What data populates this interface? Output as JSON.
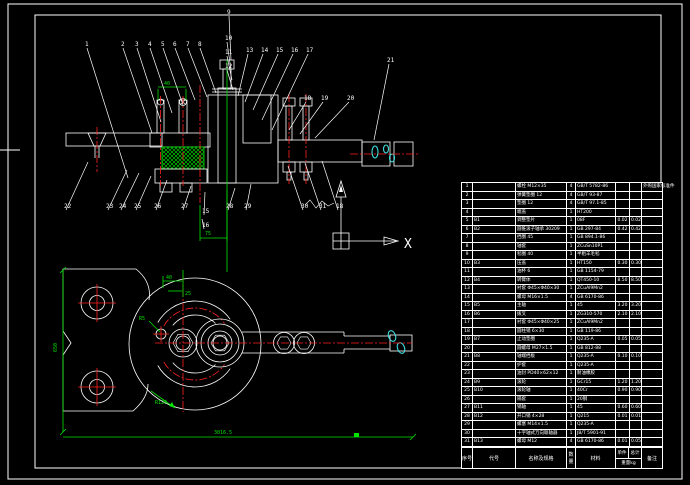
{
  "colors": {
    "background": "#000000",
    "outline": "#ffffff",
    "hatch": "#3fe0e0",
    "dimension": "#00e400",
    "centerline": "#ff2222"
  },
  "ucs": {
    "x_label": "X"
  },
  "dimensions": {
    "stud_spacing": "40",
    "hub_bore": "75",
    "plan_offset_a": "40",
    "plan_offset_b": "25",
    "plan_lead": "R5",
    "plan_arc": "R120",
    "overall_height": "650",
    "overall_width": "3016.5"
  },
  "balloons": [
    {
      "n": "1",
      "x": 85,
      "y": 46,
      "tx": 128,
      "ty": 178
    },
    {
      "n": "2",
      "x": 121,
      "y": 46,
      "tx": 152,
      "ty": 133
    },
    {
      "n": "3",
      "x": 135,
      "y": 46,
      "tx": 161,
      "ty": 122
    },
    {
      "n": "4",
      "x": 148,
      "y": 46,
      "tx": 172,
      "ty": 113
    },
    {
      "n": "5",
      "x": 161,
      "y": 46,
      "tx": 183,
      "ty": 105
    },
    {
      "n": "6",
      "x": 173,
      "y": 46,
      "tx": 195,
      "ty": 100
    },
    {
      "n": "7",
      "x": 186,
      "y": 46,
      "tx": 207,
      "ty": 97
    },
    {
      "n": "8",
      "x": 198,
      "y": 46,
      "tx": 216,
      "ty": 93
    },
    {
      "n": "9",
      "x": 227,
      "y": 14,
      "tx": 231,
      "ty": 60
    },
    {
      "n": "10",
      "x": 225,
      "y": 40,
      "tx": 231,
      "ty": 70
    },
    {
      "n": "11",
      "x": 225,
      "y": 54,
      "tx": 232,
      "ty": 80
    },
    {
      "n": "12",
      "x": 225,
      "y": 68,
      "tx": 233,
      "ty": 90
    },
    {
      "n": "13",
      "x": 246,
      "y": 52,
      "tx": 238,
      "ty": 96
    },
    {
      "n": "14",
      "x": 261,
      "y": 52,
      "tx": 245,
      "ty": 102
    },
    {
      "n": "15",
      "x": 276,
      "y": 52,
      "tx": 253,
      "ty": 110
    },
    {
      "n": "16",
      "x": 291,
      "y": 52,
      "tx": 262,
      "ty": 120
    },
    {
      "n": "17",
      "x": 306,
      "y": 52,
      "tx": 272,
      "ty": 130
    },
    {
      "n": "18",
      "x": 304,
      "y": 100,
      "tx": 289,
      "ty": 130
    },
    {
      "n": "19",
      "x": 321,
      "y": 100,
      "tx": 300,
      "ty": 134
    },
    {
      "n": "20",
      "x": 347,
      "y": 100,
      "tx": 315,
      "ty": 138
    },
    {
      "n": "21",
      "x": 387,
      "y": 62,
      "tx": 374,
      "ty": 140
    },
    {
      "n": "22",
      "x": 64,
      "y": 208,
      "tx": 88,
      "ty": 162
    },
    {
      "n": "23",
      "x": 106,
      "y": 208,
      "tx": 127,
      "ty": 170
    },
    {
      "n": "24",
      "x": 119,
      "y": 208,
      "tx": 139,
      "ty": 173
    },
    {
      "n": "25",
      "x": 134,
      "y": 208,
      "tx": 151,
      "ty": 176
    },
    {
      "n": "26",
      "x": 154,
      "y": 208,
      "tx": 167,
      "ty": 180
    },
    {
      "n": "27",
      "x": 181,
      "y": 208,
      "tx": 191,
      "ty": 186
    },
    {
      "n": "28",
      "x": 226,
      "y": 208,
      "tx": 235,
      "ty": 188
    },
    {
      "n": "29",
      "x": 244,
      "y": 208,
      "tx": 251,
      "ty": 184
    },
    {
      "n": "30",
      "x": 301,
      "y": 208,
      "tx": 288,
      "ty": 166
    },
    {
      "n": "31",
      "x": 319,
      "y": 208,
      "tx": 305,
      "ty": 163
    },
    {
      "n": "18",
      "x": 336,
      "y": 208,
      "tx": 322,
      "ty": 161
    },
    {
      "n": "15",
      "x": 202,
      "y": 213,
      "tx": 205,
      "ty": 192
    },
    {
      "n": "16",
      "x": 202,
      "y": 227,
      "tx": 202,
      "ty": 219
    }
  ],
  "bom": {
    "headers": {
      "no": "序号",
      "code": "代号",
      "name": "名称及规格",
      "qty": "数量",
      "mat": "材料",
      "w1": "单件",
      "w2": "总计",
      "w_sub": "重量kg",
      "rk": "备注"
    },
    "rows": [
      [
        "1",
        "",
        "螺栓 M12×35",
        "4",
        "GB/T 5782-86",
        "",
        "",
        "外购国家标准件"
      ],
      [
        "2",
        "",
        "弹簧垫圈 12",
        "4",
        "GB/T 93-87",
        "",
        "",
        ""
      ],
      [
        "3",
        "",
        "垫圈 12",
        "4",
        "GB/T 97.1-85",
        "",
        "",
        ""
      ],
      [
        "4",
        "",
        "端盖",
        "1",
        "HT200",
        "",
        "",
        ""
      ],
      [
        "5",
        "B1",
        "调整垫片",
        "1",
        "08F",
        "0.02",
        "0.02",
        ""
      ],
      [
        "6",
        "B2",
        "圆锥滚子轴承 30209",
        "1",
        "GB 297-84",
        "0.42",
        "0.42",
        ""
      ],
      [
        "7",
        "",
        "挡圈 45",
        "1",
        "GB 894.1-86",
        "",
        "",
        ""
      ],
      [
        "8",
        "",
        "轴套",
        "1",
        "ZCuSn10P1",
        "",
        "",
        ""
      ],
      [
        "9",
        "",
        "毡圈 40",
        "1",
        "半粗羊毛毡",
        "",
        "",
        ""
      ],
      [
        "10",
        "B3",
        "压盖",
        "1",
        "HT150",
        "0.30",
        "0.30",
        ""
      ],
      [
        "11",
        "",
        "油杯 6",
        "1",
        "GB 1154-79",
        "",
        "",
        ""
      ],
      [
        "12",
        "B4",
        "转臂体",
        "1",
        "QT450-10",
        "8.50",
        "8.50",
        ""
      ],
      [
        "13",
        "",
        "衬套 Φ45×Φ40×30",
        "1",
        "ZCuAl9Mn2",
        "",
        "",
        ""
      ],
      [
        "14",
        "",
        "螺母 M16×1.5",
        "4",
        "GB 6170-86",
        "",
        "",
        ""
      ],
      [
        "15",
        "B5",
        "主轴",
        "1",
        "45",
        "3.20",
        "3.20",
        ""
      ],
      [
        "16",
        "B6",
        "拨叉",
        "1",
        "ZG310-570",
        "2.10",
        "2.10",
        ""
      ],
      [
        "17",
        "",
        "衬套 Φ45×Φ40×25",
        "1",
        "ZCuAl9Mn2",
        "",
        "",
        ""
      ],
      [
        "18",
        "",
        "圆柱销 6×30",
        "1",
        "GB 119-86",
        "",
        "",
        ""
      ],
      [
        "19",
        "B7",
        "止动垫圈",
        "1",
        "Q235-A",
        "0.05",
        "0.05",
        ""
      ],
      [
        "20",
        "",
        "圆螺母 M27×1.5",
        "1",
        "GB 812-88",
        "",
        "",
        ""
      ],
      [
        "21",
        "B8",
        "轴端挡板",
        "1",
        "Q235-A",
        "0.10",
        "0.10",
        ""
      ],
      [
        "22",
        "",
        "护套",
        "1",
        "Q235-A",
        "",
        "",
        ""
      ],
      [
        "23",
        "",
        "油封 PD40×62×12",
        "1",
        "耐油橡胶",
        "",
        "",
        ""
      ],
      [
        "24",
        "B9",
        "滚轮",
        "1",
        "GCr15",
        "1.20",
        "1.20",
        ""
      ],
      [
        "25",
        "B10",
        "滚轮轴",
        "1",
        "40Cr",
        "0.90",
        "0.90",
        ""
      ],
      [
        "26",
        "",
        "隔套",
        "1",
        "20钢",
        "",
        "",
        ""
      ],
      [
        "27",
        "B11",
        "销轴",
        "1",
        "45",
        "0.60",
        "0.60",
        ""
      ],
      [
        "28",
        "B12",
        "开口销 4×28",
        "1",
        "Q215",
        "0.01",
        "0.01",
        ""
      ],
      [
        "29",
        "",
        "螺塞 M14×1.5",
        "1",
        "Q235-A",
        "",
        "",
        ""
      ],
      [
        "30",
        "",
        "十字轴式万向联轴器",
        "1",
        "JB/T 5901-91",
        "",
        "",
        ""
      ],
      [
        "31",
        "B13",
        "螺母 M12",
        "4",
        "GB 6170-86",
        "0.01",
        "0.05",
        ""
      ]
    ]
  }
}
